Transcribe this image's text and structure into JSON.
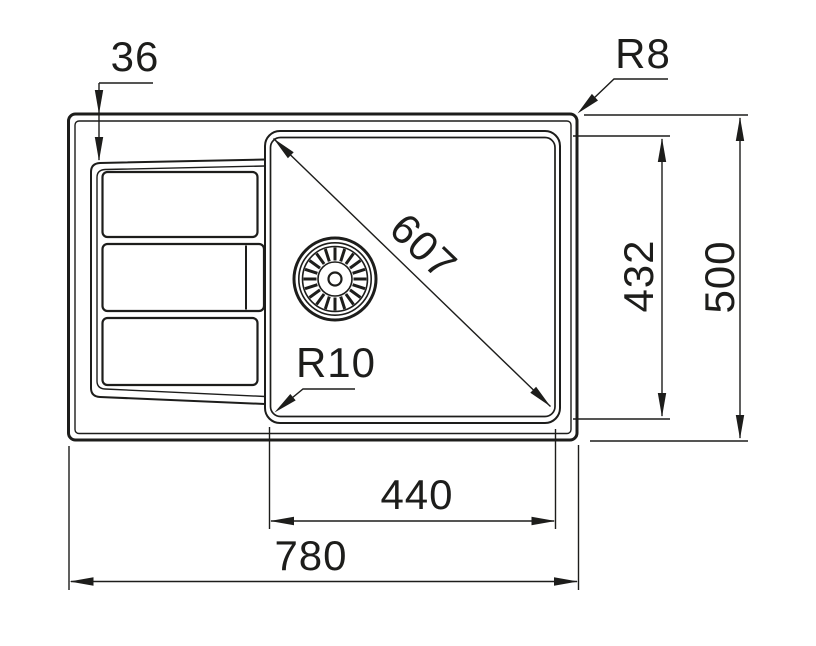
{
  "drawing": {
    "background_color": "#ffffff",
    "line_color": "#1d1d1b",
    "dimensions": {
      "edge_inset": "36",
      "outer_corner_radius": "R8",
      "diagonal": "607",
      "inner_depth": "432",
      "overall_depth": "500",
      "inner_width": "440",
      "overall_width": "780",
      "inner_corner_radius": "R10"
    }
  }
}
